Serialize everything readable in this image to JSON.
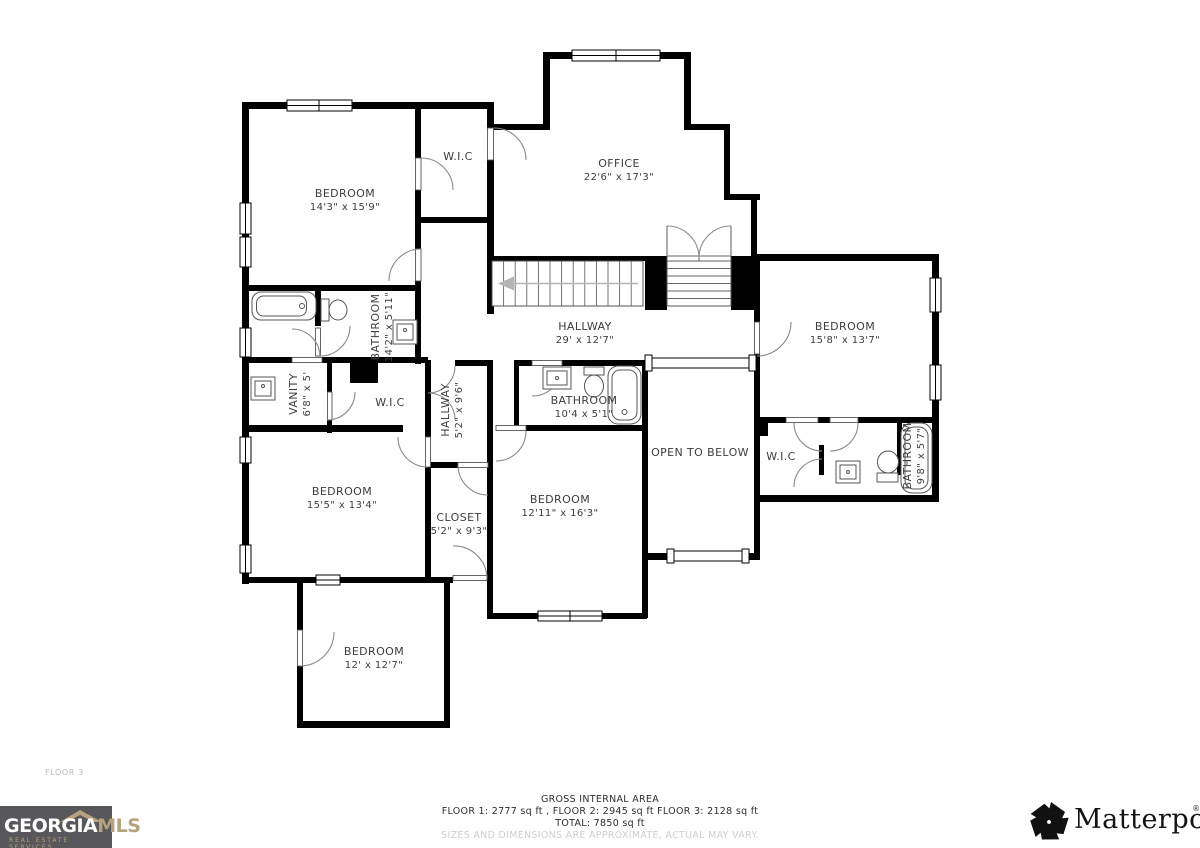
{
  "floor_label": "FLOOR 3",
  "rooms": [
    {
      "name": "BEDROOM",
      "dims": "14'3\" x 15'9\""
    },
    {
      "name": "W.I.C",
      "dims": ""
    },
    {
      "name": "OFFICE",
      "dims": "22'6\" x 17'3\""
    },
    {
      "name": "BATHROOM",
      "dims": "14'2\" x 5'11\""
    },
    {
      "name": "HALLWAY",
      "dims": "29' x 12'7\""
    },
    {
      "name": "BEDROOM",
      "dims": "15'8\" x 13'7\""
    },
    {
      "name": "VANITY",
      "dims": "6'8\" x 5'"
    },
    {
      "name": "W.I.C",
      "dims": ""
    },
    {
      "name": "HALLWAY",
      "dims": "5'2\" x 9'6\""
    },
    {
      "name": "BATHROOM",
      "dims": "10'4 x 5'1\""
    },
    {
      "name": "OPEN TO BELOW",
      "dims": ""
    },
    {
      "name": "W.I.C",
      "dims": ""
    },
    {
      "name": "BATHROOM",
      "dims": "9'8\" x 5'7\""
    },
    {
      "name": "BEDROOM",
      "dims": "15'5\" x 13'4\""
    },
    {
      "name": "CLOSET",
      "dims": "5'2\" x 9'3\""
    },
    {
      "name": "BEDROOM",
      "dims": "12'11\" x 16'3\""
    },
    {
      "name": "BEDROOM",
      "dims": "12' x 12'7\""
    }
  ],
  "footer": {
    "heading": "GROSS INTERNAL AREA",
    "line2": "FLOOR 1: 2777 sq ft , FLOOR 2: 2945 sq ft FLOOR 3: 2128 sq ft",
    "line3": "TOTAL: 7850 sq ft",
    "disclaimer": "SIZES AND DIMENSIONS ARE APPROXIMATE, ACTUAL MAY VARY."
  },
  "logos": {
    "georgia_part1": "GEORGIA",
    "georgia_part2": "MLS",
    "georgia_tagline": "REAL ESTATE SERVICES",
    "matterport": "Matterport",
    "matterport_mark": "®"
  },
  "colors": {
    "wall": "#000000",
    "georgia_bg": "#58575b",
    "georgia_gold": "#b6a27c",
    "label_text": "#3d3d3d"
  }
}
